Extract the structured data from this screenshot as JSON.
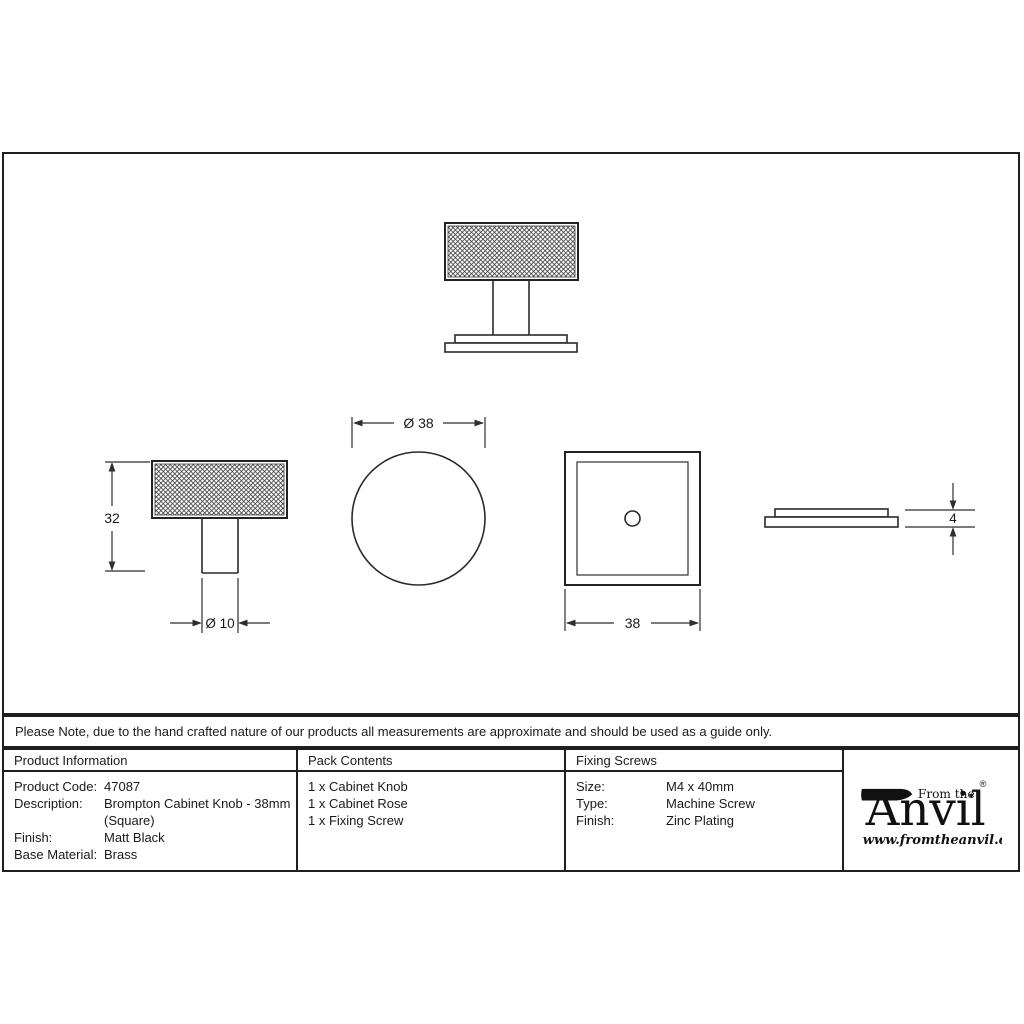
{
  "note": "Please Note, due to the hand crafted nature of our products all measurements are approximate and should be used as a guide only.",
  "product_info": {
    "header": "Product Information",
    "rows": [
      {
        "label": "Product Code:",
        "value": "47087"
      },
      {
        "label": "Description:",
        "value": "Brompton Cabinet Knob - 38mm"
      },
      {
        "label": "",
        "value": "(Square)"
      },
      {
        "label": "Finish:",
        "value": "Matt Black"
      },
      {
        "label": "Base Material:",
        "value": "Brass"
      }
    ]
  },
  "pack_contents": {
    "header": "Pack Contents",
    "items": [
      "1 x Cabinet Knob",
      "1 x Cabinet Rose",
      "1 x Fixing Screw"
    ]
  },
  "fixing_screws": {
    "header": "Fixing Screws",
    "rows": [
      {
        "label": "Size:",
        "value": "M4 x 40mm"
      },
      {
        "label": "Type:",
        "value": "Machine Screw"
      },
      {
        "label": "Finish:",
        "value": "Zinc Plating"
      }
    ]
  },
  "brand": {
    "prefix": "From the",
    "name": "Anvil",
    "name_tail": "nvil",
    "diamond": "♦",
    "registered": "®",
    "url": "www.fromtheanvil.co.uk"
  },
  "dimensions": {
    "knob_height": "32",
    "stem_diameter": "Ø 10",
    "knob_diameter": "Ø 38",
    "rose_width": "38",
    "rose_thickness": "4"
  },
  "colors": {
    "line": "#1f1f1f",
    "ink": "#1a1a1a"
  }
}
